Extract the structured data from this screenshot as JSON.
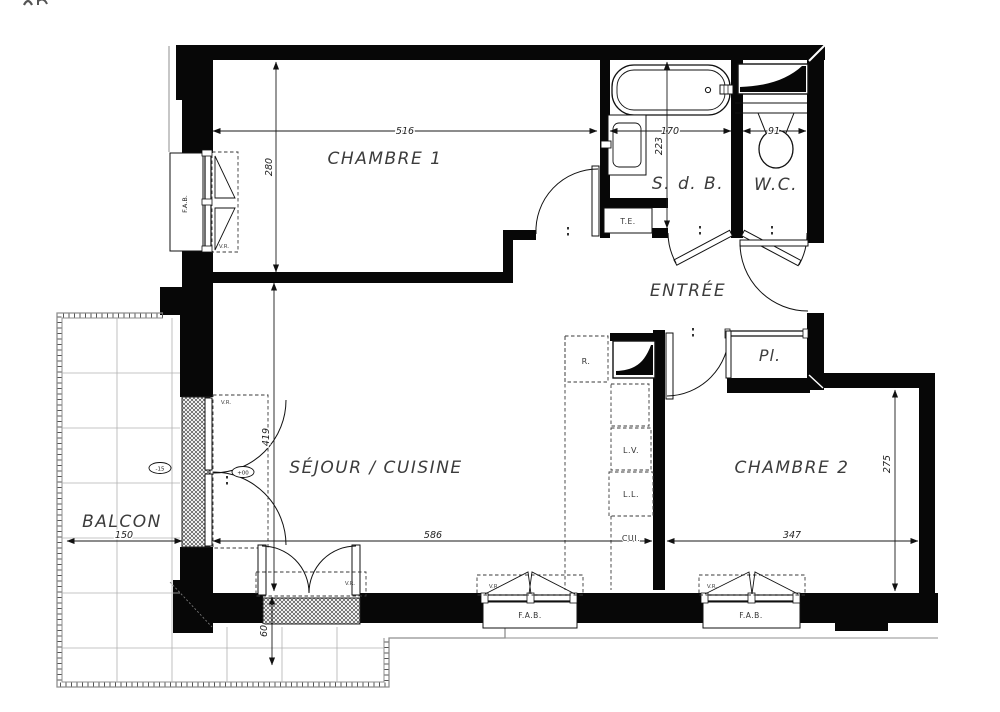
{
  "plan": {
    "rooms": {
      "chambre1": "CHAMBRE 1",
      "sdb": "S. d. B.",
      "wc": "W.C.",
      "entree": "ENTRÉE",
      "sejour_cuisine": "SÉJOUR / CUISINE",
      "chambre2": "CHAMBRE 2",
      "balcon": "BALCON",
      "placard": "Pl.",
      "cuisine": "CUI."
    },
    "dims": {
      "chambre1_w": "516",
      "chambre1_h": "280",
      "sdb_w": "170",
      "sdb_h": "223",
      "wc_w": "91",
      "sejour_h": "419",
      "sejour_w": "586",
      "chambre2_w": "347",
      "chambre2_h": "275",
      "balcon_w": "150",
      "balcon_d": "60"
    },
    "labels": {
      "fab": "F.A.B.",
      "vr": "V.R.",
      "te": "T.E.",
      "fridge": "R.",
      "dishwasher": "L.V.",
      "washing_machine": "L.L.",
      "level_balcony": "-15",
      "level_floor": "+00"
    }
  }
}
